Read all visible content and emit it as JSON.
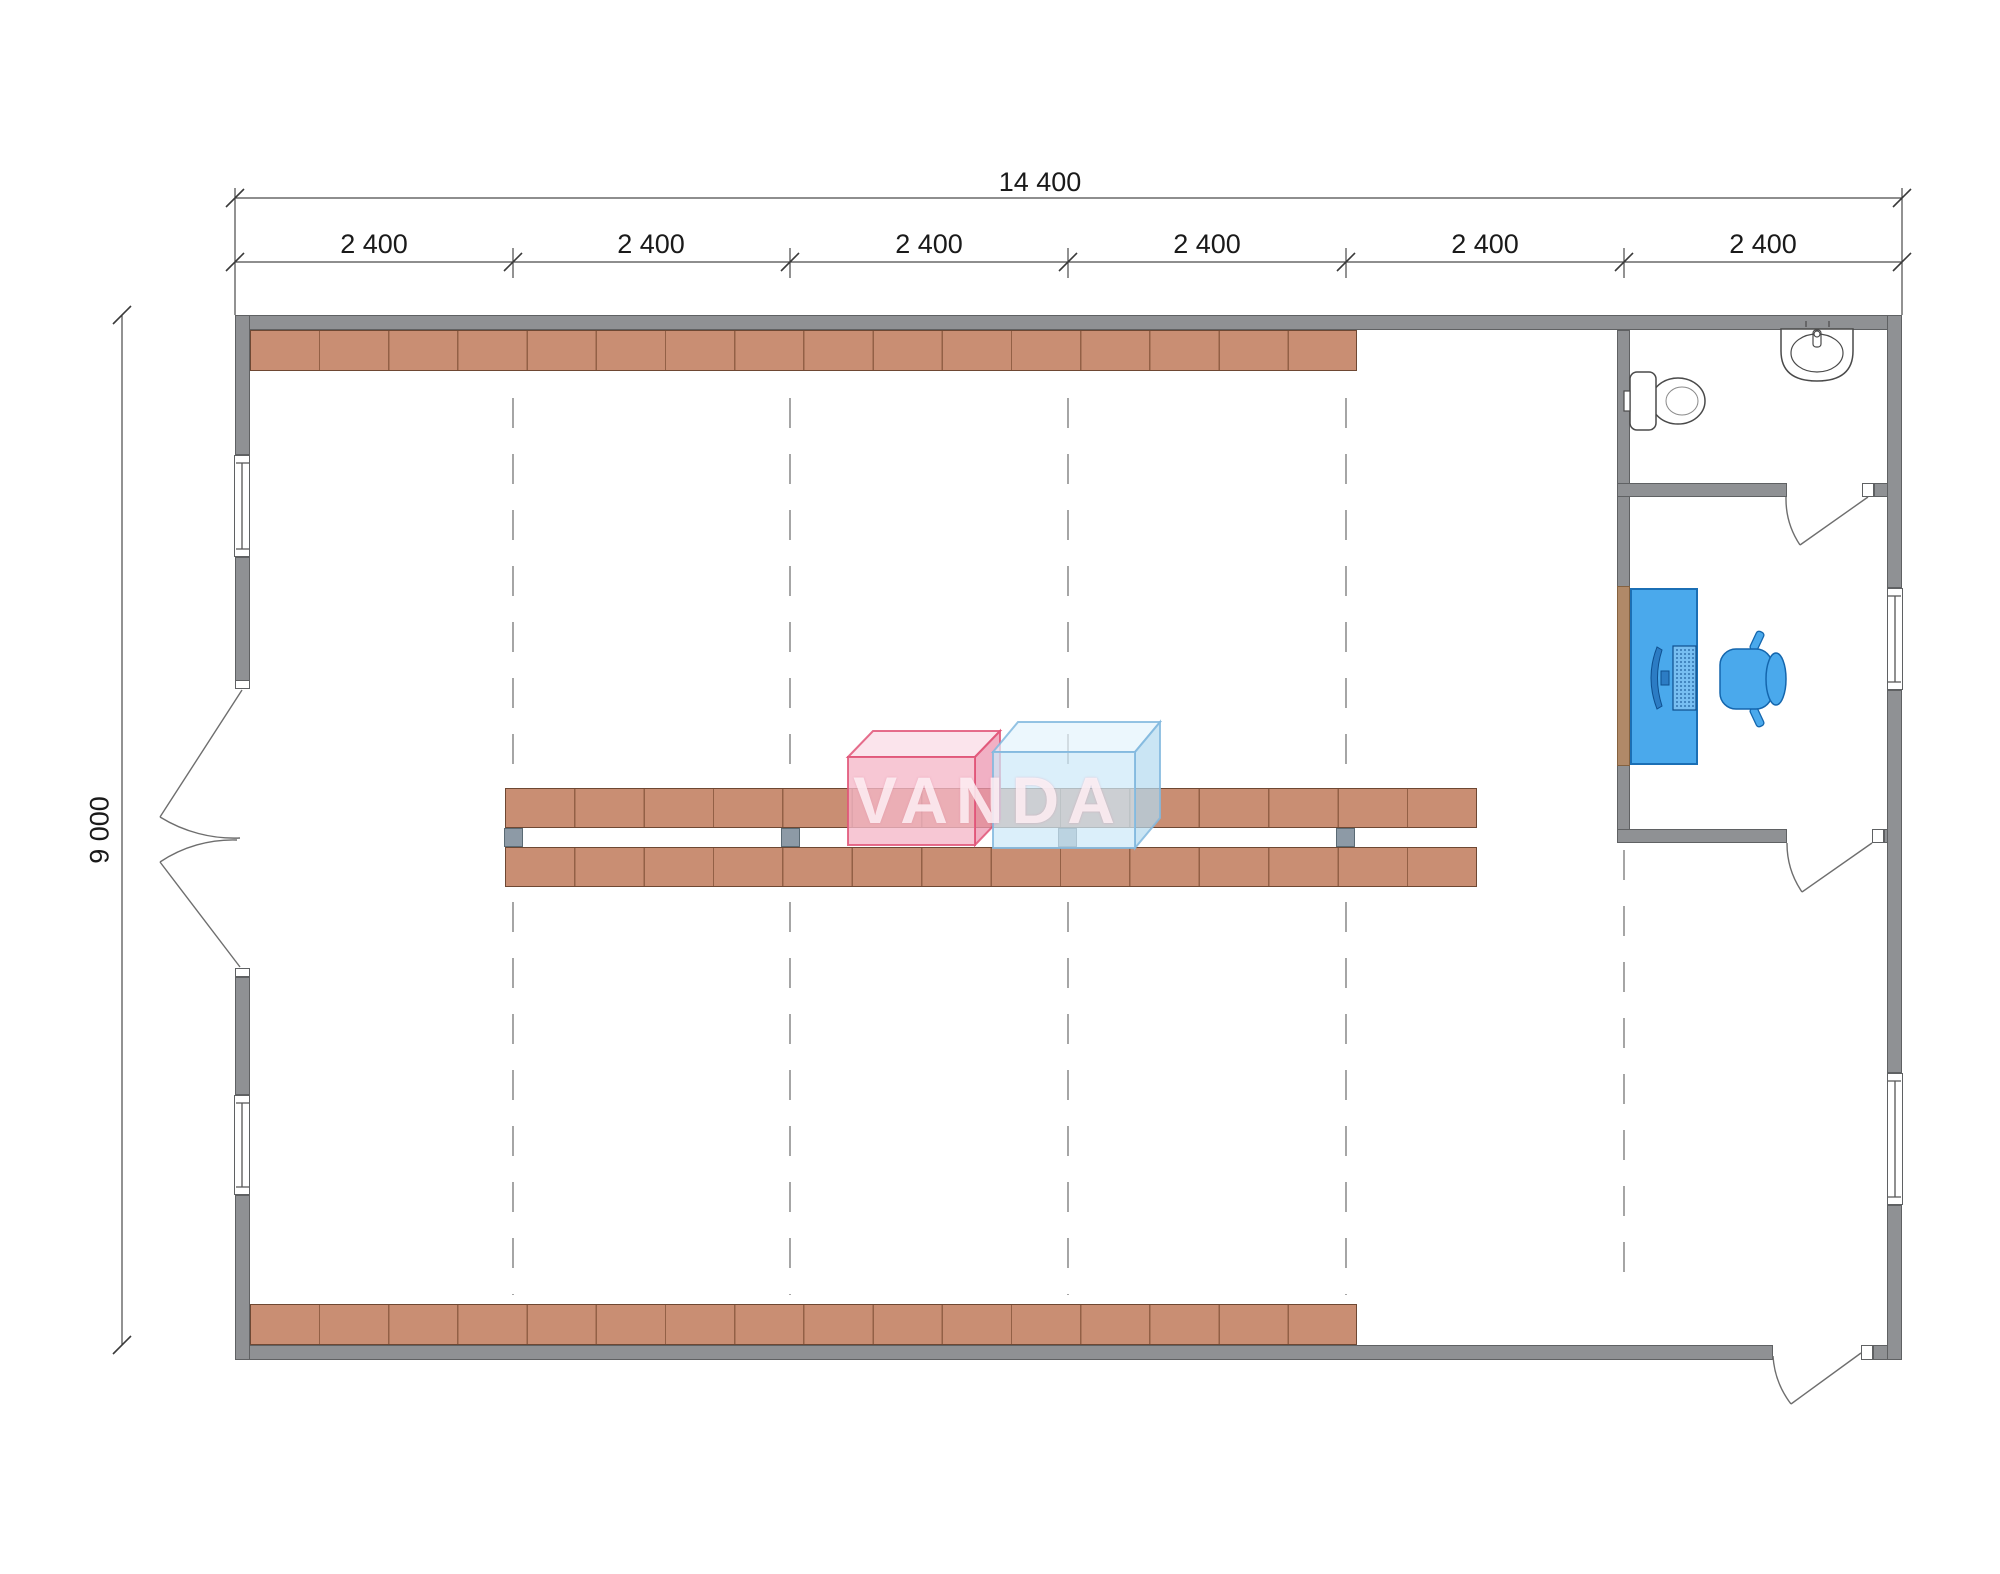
{
  "drawing": {
    "type": "architectural floor plan",
    "watermark": "VANDA",
    "dimensions": {
      "overall_width": "14 400",
      "overall_height": "9 000",
      "bays": [
        "2 400",
        "2 400",
        "2 400",
        "2 400",
        "2 400",
        "2 400"
      ],
      "bay_count": 6
    },
    "colors": {
      "wall_gray": "#8f9194",
      "shelf_brown": "#c98e73",
      "post_gray_blue": "#8d9aa6",
      "furniture_blue": "#4aa9ec",
      "watermark_pink": "#f4b2c5",
      "watermark_blue": "#cde9f8",
      "dimension_text": "#1a1a1a"
    }
  }
}
